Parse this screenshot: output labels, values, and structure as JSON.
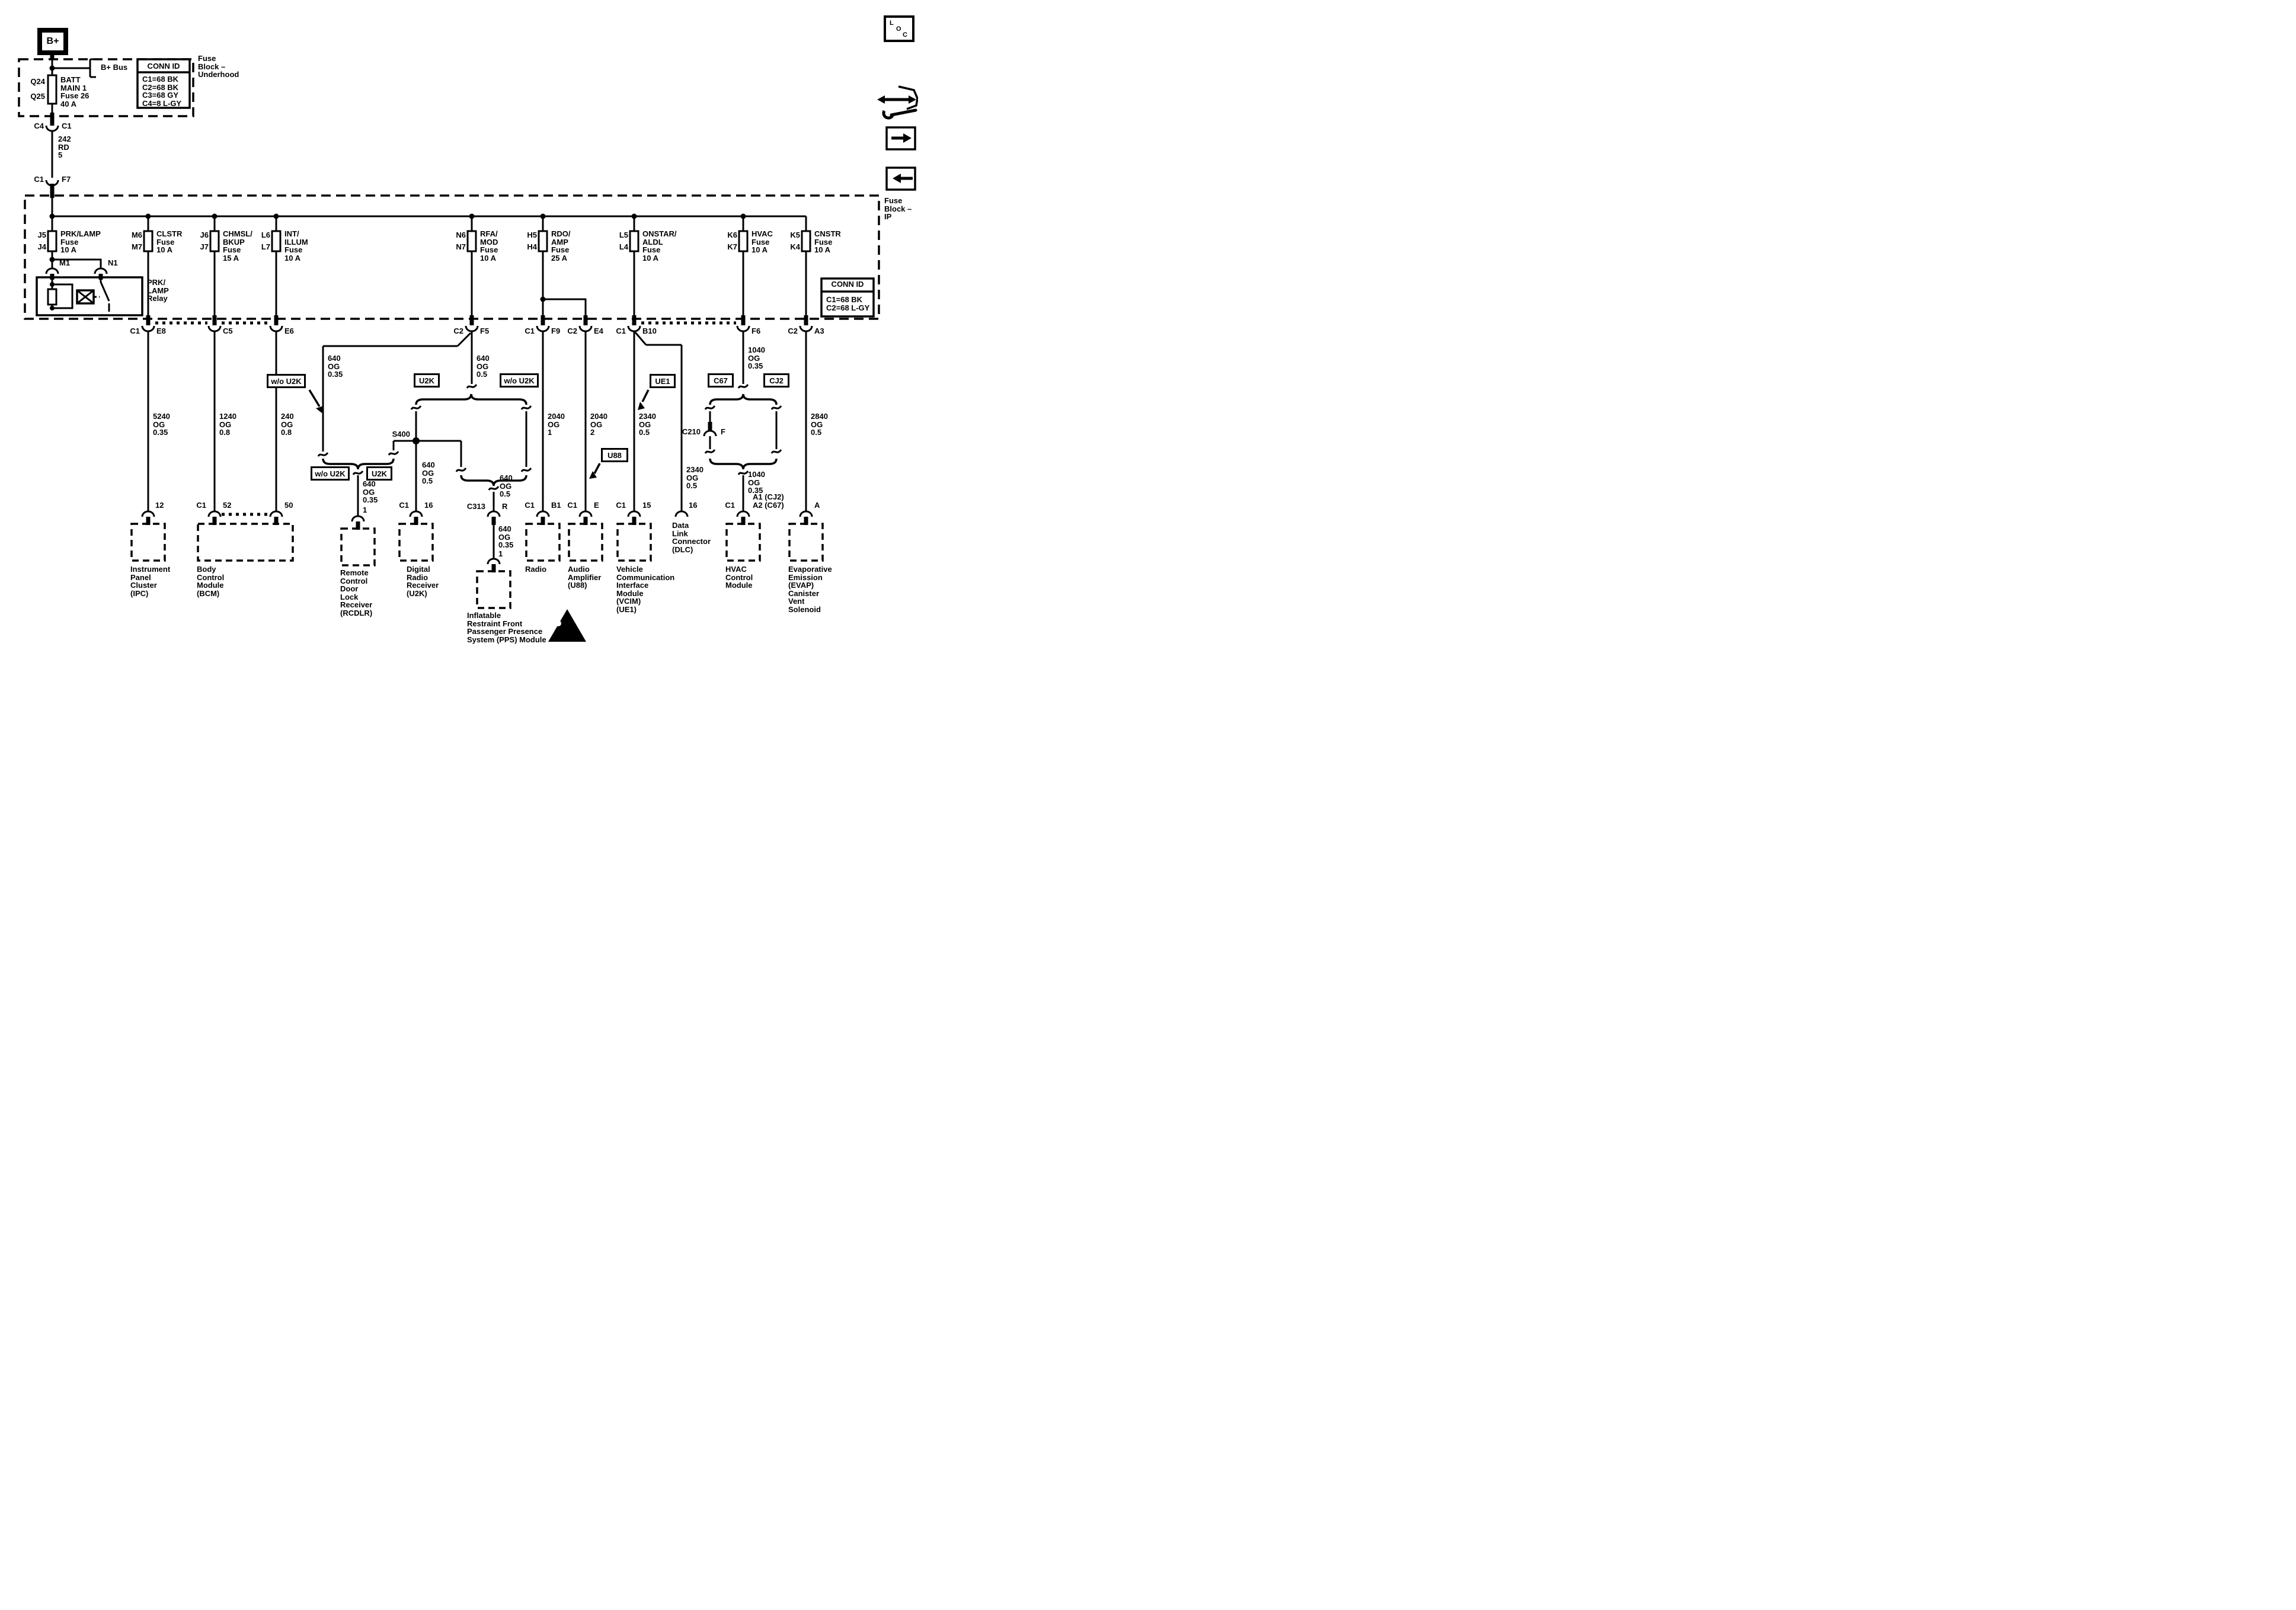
{
  "b_plus": "B+",
  "underhood": {
    "bus_label": "B+ Bus",
    "fuse_pos_top": "Q24",
    "fuse_pos_bottom": "Q25",
    "fuse_name": "BATT\nMAIN 1\nFuse 26\n40 A",
    "conn_id_header": "CONN ID",
    "conn_id_rows": "C1=68 BK\nC2=68 BK\nC3=68 GY\nC4=8 L-GY",
    "block_label": "Fuse\nBlock –\nUnderhood"
  },
  "feed": {
    "c4": "C4",
    "c1_top": "C1",
    "wire": "242\nRD\n5",
    "c1_bottom": "C1",
    "f7": "F7"
  },
  "ip": {
    "block_label": "Fuse\nBlock –\nIP",
    "conn_id_header": "CONN ID",
    "conn_id_rows": "C1=68 BK\nC2=68 L-GY",
    "relay_label": "PRK/\nLAMP\nRelay",
    "m1": "M1",
    "n1": "N1",
    "fuses": [
      {
        "top": "J5",
        "bottom": "J4",
        "name": "PRK/LAMP\nFuse\n10 A"
      },
      {
        "top": "M6",
        "bottom": "M7",
        "name": "CLSTR\nFuse\n10 A"
      },
      {
        "top": "J6",
        "bottom": "J7",
        "name": "CHMSL/\nBKUP\nFuse\n15 A"
      },
      {
        "top": "L6",
        "bottom": "L7",
        "name": "INT/\nILLUM\nFuse\n10 A"
      },
      {
        "top": "N6",
        "bottom": "N7",
        "name": "RFA/\nMOD\nFuse\n10 A"
      },
      {
        "top": "H5",
        "bottom": "H4",
        "name": "RDO/\nAMP\nFuse\n25 A"
      },
      {
        "top": "L5",
        "bottom": "L4",
        "name": "ONSTAR/\nALDL\nFuse\n10 A"
      },
      {
        "top": "K6",
        "bottom": "K7",
        "name": "HVAC\nFuse\n10 A"
      },
      {
        "top": "K5",
        "bottom": "K4",
        "name": "CNSTR\nFuse\n10 A"
      }
    ]
  },
  "row1": {
    "e8_l": "C1",
    "e8_r": "E8",
    "c5": "C5",
    "e6": "E6",
    "f5_l": "C2",
    "f5_r": "F5",
    "f9_l": "C1",
    "f9_r": "F9",
    "e4_l": "C2",
    "e4_r": "E4",
    "b10_l": "C1",
    "b10_r": "B10",
    "f6": "F6",
    "a3_l": "C2",
    "a3_r": "A3"
  },
  "wires": {
    "ipc": "5240\nOG\n0.35",
    "bcm_52": "1240\nOG\n0.8",
    "bcm_50": "240\nOG\n0.8",
    "f5_branch": "640\nOG\n0.35",
    "f5_main": "640\nOG\n0.5",
    "s400": "S400",
    "drr": "640\nOG\n0.5",
    "rcdlr": "640\nOG\n0.35",
    "pps_upper": "640\nOG\n0.5",
    "pps_lower": "640\nOG\n0.35",
    "radio": "2040\nOG\n1",
    "amp": "2040\nOG\n2",
    "vcim": "2340\nOG\n0.5",
    "dlc": "2340\nOG\n0.5",
    "hvac_upper": "1040\nOG\n0.35",
    "hvac_lower": "1040\nOG\n0.35",
    "evap": "2840\nOG\n0.5"
  },
  "options": {
    "wo_u2k_top": "w/o U2K",
    "u2k_mid_l": "U2K",
    "wo_u2k_mid_r": "w/o U2K",
    "wo_u2k_bot_l": "w/o U2K",
    "u2k_bot_r": "U2K",
    "ue1": "UE1",
    "u88": "U88",
    "c67": "C67",
    "cj2": "CJ2"
  },
  "inline": {
    "c210": "C210",
    "c210_cav": "F",
    "c313": "C313",
    "c313_cav": "R"
  },
  "row2": {
    "ipc": "12",
    "bcm_l": "C1",
    "bcm_52": "52",
    "bcm_50": "50",
    "rcdlr": "1",
    "drr_l": "C1",
    "drr_r": "16",
    "pps": "1",
    "radio_l": "C1",
    "radio_r": "B1",
    "amp_l": "C1",
    "amp_r": "E",
    "vcim_l": "C1",
    "vcim_r": "15",
    "dlc": "16",
    "hvac_l": "C1",
    "hvac_r": "A1 (CJ2)\nA2 (C67)",
    "evap": "A"
  },
  "modules": {
    "ipc": "Instrument\nPanel\nCluster\n(IPC)",
    "bcm": "Body\nControl\nModule\n(BCM)",
    "rcdlr": "Remote\nControl\nDoor\nLock\nReceiver\n(RCDLR)",
    "drr": "Digital\nRadio\nReceiver\n(U2K)",
    "pps": "Inflatable\nRestraint Front\nPassenger Presence\nSystem (PPS) Module",
    "radio": "Radio",
    "amp": "Audio\nAmplifier\n(U88)",
    "vcim": "Vehicle\nCommunication\nInterface\nModule\n(VCIM)\n(UE1)",
    "dlc": "Data\nLink\nConnector\n(DLC)",
    "hvac": "HVAC\nControl\nModule",
    "evap": "Evaporative\nEmission\n(EVAP)\nCanister\nVent\nSolenoid"
  },
  "nav": {
    "loc_l": "L",
    "loc_o": "O",
    "loc_c": "C"
  }
}
